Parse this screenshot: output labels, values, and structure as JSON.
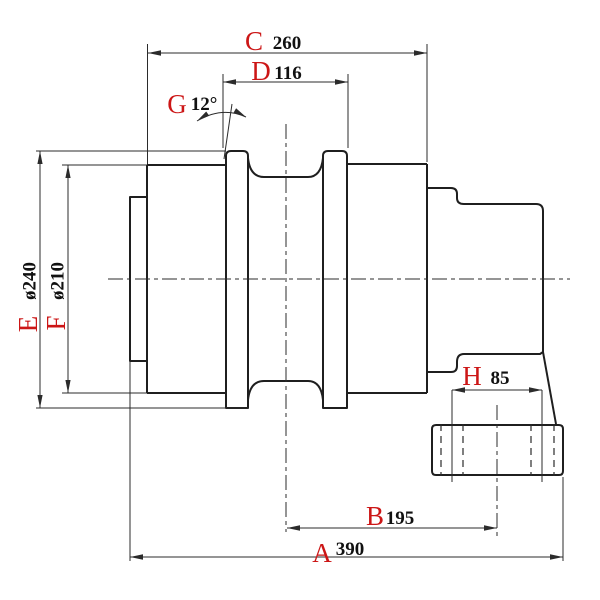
{
  "drawing": {
    "title": "Track roller cross-section drawing",
    "colors": {
      "line": "#1f1f1f",
      "thin": "#2b2b2b",
      "label": "#cc1616",
      "value": "#111111",
      "bg": "#ffffff"
    },
    "dimensions": {
      "A": {
        "letter": "A",
        "value": "390"
      },
      "B": {
        "letter": "B",
        "value": "195"
      },
      "C": {
        "letter": "C",
        "value": "260"
      },
      "D": {
        "letter": "D",
        "value": "116"
      },
      "E": {
        "letter": "E",
        "value": "ø240"
      },
      "F": {
        "letter": "F",
        "value": "ø210"
      },
      "G": {
        "letter": "G",
        "value": "12°"
      },
      "H": {
        "letter": "H",
        "value": "85"
      }
    }
  }
}
